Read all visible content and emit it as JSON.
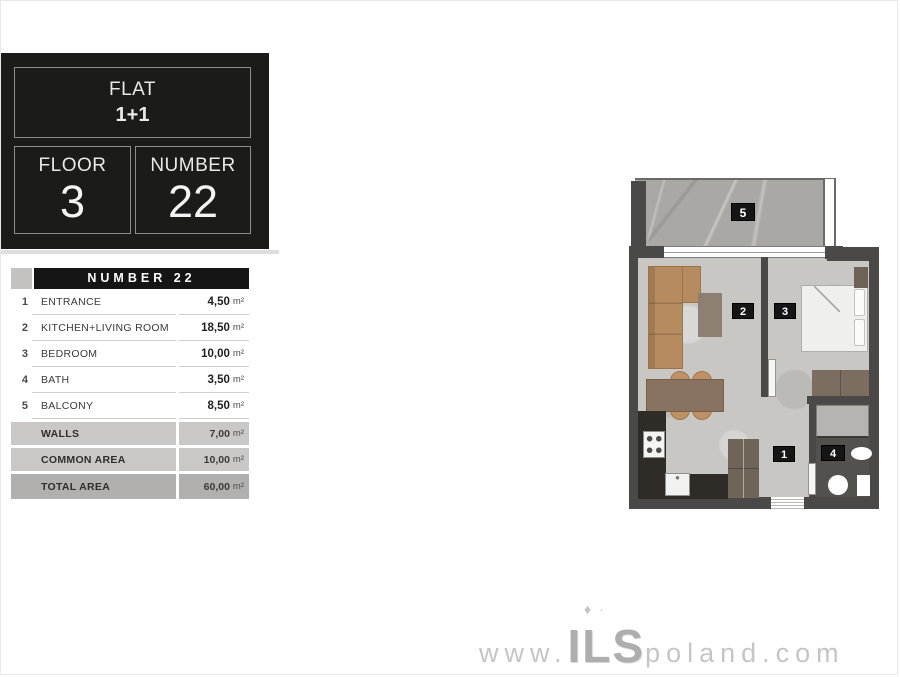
{
  "panel": {
    "flat_label": "FLAT",
    "flat_value": "1+1",
    "floor_label": "FLOOR",
    "floor_value": "3",
    "number_label": "NUMBER",
    "number_value": "22"
  },
  "table": {
    "header": "NUMBER 22",
    "rows": [
      {
        "num": "1",
        "label": "ENTRANCE",
        "value": "4,50",
        "unit": "m²"
      },
      {
        "num": "2",
        "label": "KITCHEN+LIVING ROOM",
        "value": "18,50",
        "unit": "m²"
      },
      {
        "num": "3",
        "label": "BEDROOM",
        "value": "10,00",
        "unit": "m²"
      },
      {
        "num": "4",
        "label": "BATH",
        "value": "3,50",
        "unit": "m²"
      },
      {
        "num": "5",
        "label": "BALCONY",
        "value": "8,50",
        "unit": "m²"
      }
    ],
    "summary_rows": [
      {
        "label": "WALLS",
        "value": "7,00",
        "unit": "m²"
      },
      {
        "label": "COMMON AREA",
        "value": "10,00",
        "unit": "m²"
      }
    ],
    "total_row": {
      "label": "TOTAL AREA",
      "value": "60,00",
      "unit": "m²"
    }
  },
  "floorplan": {
    "tags": {
      "t1": "1",
      "t2": "2",
      "t3": "3",
      "t4": "4",
      "t5": "5"
    }
  },
  "watermark": {
    "prefix": "www.",
    "brand": "ILS",
    "suffix": "poland.com",
    "decor": "♦·"
  },
  "colors": {
    "panel_bg": "#1b1b1a",
    "table_header_bg": "#151515",
    "summary_row_bg": "#c9c8c6",
    "total_row_bg": "#b1b0ae",
    "wall": "#4a4947",
    "balcony_floor": "#a9a8a5",
    "room_floor": "#c8c7c4",
    "bath_floor": "#53514e",
    "wood": "#b68b60"
  }
}
